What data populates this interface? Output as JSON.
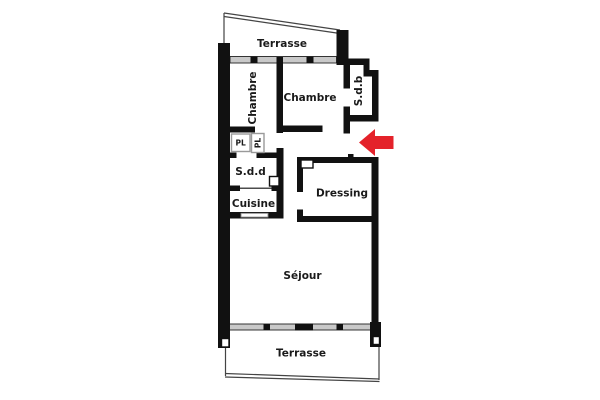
{
  "plan": {
    "type": "floor-plan",
    "rooms": {
      "terrasse_top": "Terrasse",
      "chambre_left": "Chambre",
      "chambre_right": "Chambre",
      "sdb": "S.d.b",
      "pl_left": "PL",
      "pl_right": "PL",
      "sdd": "S.d.d",
      "cuisine": "Cuisine",
      "dressing": "Dressing",
      "sejour": "Séjour",
      "terrasse_bottom": "Terrasse"
    },
    "colors": {
      "wall": "#111111",
      "window_band": "#c9c9c9",
      "arrow": "#e4222a",
      "label": "#1a1a1a",
      "background": "#ffffff"
    }
  }
}
